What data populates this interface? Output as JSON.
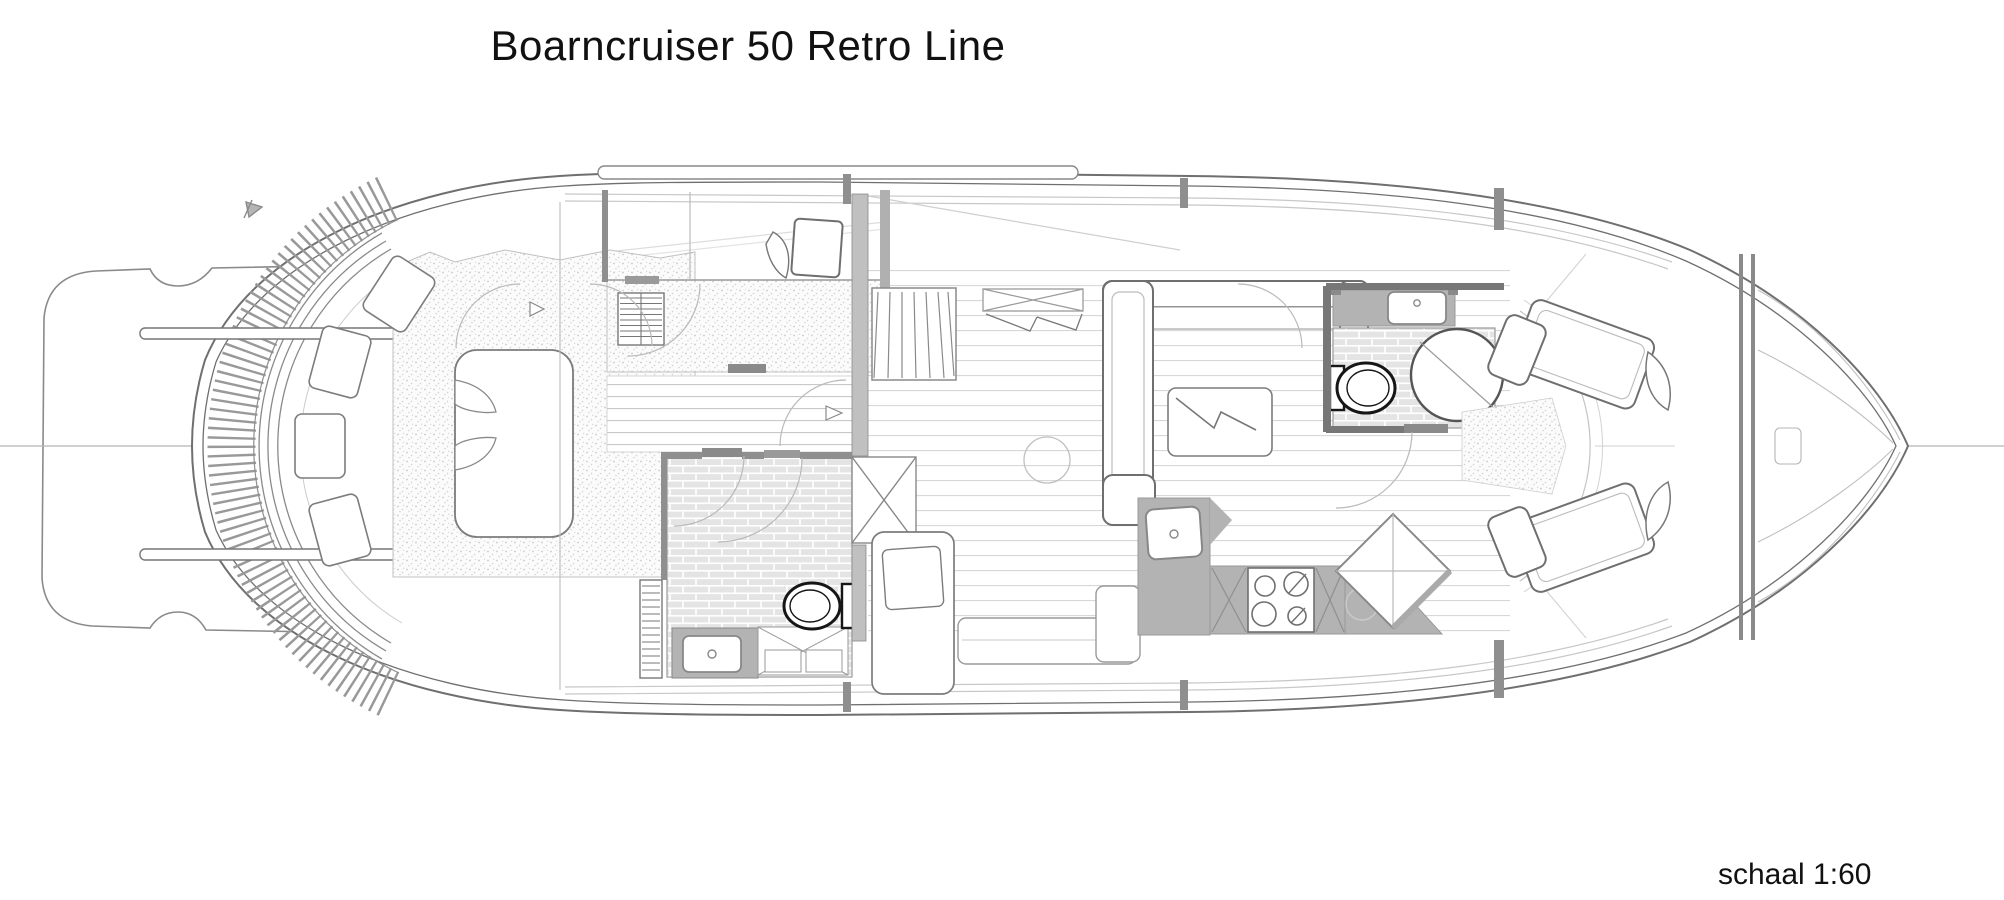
{
  "document": {
    "title": "Boarncruiser 50 Retro Line",
    "scale_label": "schaal 1:60",
    "background": "#ffffff",
    "ink": "#6f6f6f",
    "line_light": "#c9c9c9",
    "counter_fill": "#b3b3b3",
    "tile_fill": "#e4e4e4",
    "toilet_ink": "#161616"
  },
  "plan": {
    "drawing_type": "deck-plan-top-view",
    "features": [
      "swim-platform",
      "boarding-rails",
      "aft-deck-fan-teak",
      "aft-bench-cushions",
      "aft-cabin-bed",
      "guest-berth",
      "hanging-lockers",
      "aft-bathroom",
      "toilet",
      "washbasin",
      "shower-cabin",
      "companionway-stairs",
      "salon-sofa",
      "coffee-table",
      "sideboard",
      "galley-counter",
      "sink",
      "stove-4-burner",
      "corner-diamond-counter",
      "forward-bathroom",
      "v-berth",
      "bow-bulkhead",
      "foredeck"
    ]
  }
}
